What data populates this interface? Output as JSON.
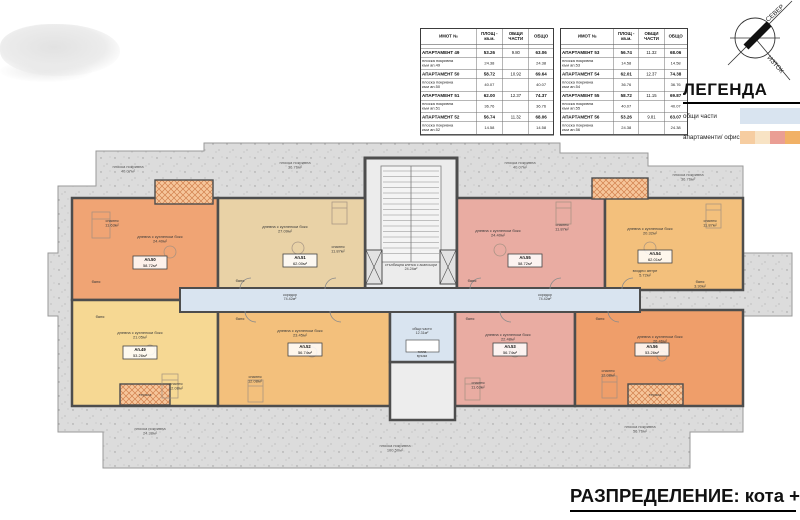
{
  "tables": {
    "headers": [
      "ИМОТ №",
      "ПЛОЩ - кв.м.",
      "ОБЩИ ЧАСТИ",
      "ОБЩО"
    ],
    "left": {
      "rows": [
        {
          "type": "apt",
          "label": "АПАРТАМЕНТ 49",
          "area": "53.26",
          "common": "9.80",
          "total": "63.06"
        },
        {
          "type": "roof",
          "label": "плоска покривна",
          "label2": "към ап.49",
          "area": "24.38",
          "common": "",
          "total": "24.38"
        },
        {
          "type": "apt",
          "label": "АПАРТАМЕНТ 50",
          "area": "58.72",
          "common": "10.92",
          "total": "69.64"
        },
        {
          "type": "roof",
          "label": "плоска покривна",
          "label2": "към ап.50",
          "area": "40.07",
          "common": "",
          "total": "40.07"
        },
        {
          "type": "apt",
          "label": "АПАРТАМЕНТ 51",
          "area": "62.00",
          "common": "12.37",
          "total": "74.37"
        },
        {
          "type": "roof",
          "label": "плоска покривна",
          "label2": "към ап.51",
          "area": "36.76",
          "common": "",
          "total": "36.76"
        },
        {
          "type": "apt",
          "label": "АПАРТАМЕНТ 52",
          "area": "56.74",
          "common": "11.32",
          "total": "68.06"
        },
        {
          "type": "roof",
          "label": "плоска покривна",
          "label2": "към ап.52",
          "area": "14.58",
          "common": "",
          "total": "14.58"
        }
      ]
    },
    "right": {
      "rows": [
        {
          "type": "apt",
          "label": "АПАРТАМЕНТ 53",
          "area": "56.74",
          "common": "11.32",
          "total": "68.06"
        },
        {
          "type": "roof",
          "label": "плоска покривна",
          "label2": "към ап.53",
          "area": "14.58",
          "common": "",
          "total": "14.58"
        },
        {
          "type": "apt",
          "label": "АПАРТАМЕНТ 54",
          "area": "62.01",
          "common": "12.37",
          "total": "74.38"
        },
        {
          "type": "roof",
          "label": "плоска покривна",
          "label2": "към ап.54",
          "area": "36.76",
          "common": "",
          "total": "36.76"
        },
        {
          "type": "apt",
          "label": "АПАРТАМЕНТ 55",
          "area": "58.72",
          "common": "11.15",
          "total": "69.87"
        },
        {
          "type": "roof",
          "label": "плоска покривна",
          "label2": "към ап.55",
          "area": "40.07",
          "common": "",
          "total": "40.07"
        },
        {
          "type": "apt",
          "label": "АПАРТАМЕНТ 56",
          "area": "53.26",
          "common": "9.81",
          "total": "63.07"
        },
        {
          "type": "roof",
          "label": "плоска покривна",
          "label2": "към ап.56",
          "area": "24.38",
          "common": "",
          "total": "24.38"
        }
      ]
    }
  },
  "legend": {
    "title": "ЛЕГЕНДА",
    "items": [
      {
        "label": "общи части",
        "color": "#d9e4f0"
      },
      {
        "label": "апартаменти/ офиси",
        "colors": [
          "#f6cda1",
          "#f8e3c4",
          "#ea9e94",
          "#f1b166"
        ]
      }
    ]
  },
  "compass": {
    "north": "СЕВЕР",
    "east": "ИЗТОК"
  },
  "title_block": {
    "text": "РАЗПРЕДЕЛЕНИЕ: кота +14.88"
  },
  "plan": {
    "stair_label": {
      "lines": [
        "стълбищна клетка с асансьори",
        "24.24м²"
      ],
      "x": 411,
      "y": 266
    },
    "lobby_label": {
      "lines": [
        "общи части",
        "12.31м²"
      ],
      "x": 422,
      "y": 330
    },
    "link_label": {
      "lines": [
        "топла",
        "връзка"
      ],
      "x": 422,
      "y": 349
    },
    "corridor_labels": [
      {
        "lines": [
          "коридор",
          "74.42м²"
        ],
        "x": 290,
        "y": 296
      },
      {
        "lines": [
          "коридор",
          "74.42м²"
        ],
        "x": 545,
        "y": 296
      }
    ],
    "units": [
      {
        "id": "Ап.49",
        "area": "53.26м²",
        "x": 140,
        "y": 352
      },
      {
        "id": "Ап.50",
        "area": "58.72м²",
        "x": 150,
        "y": 262
      },
      {
        "id": "Ап.51",
        "area": "62.00м²",
        "x": 300,
        "y": 260
      },
      {
        "id": "Ап.52",
        "area": "56.74м²",
        "x": 305,
        "y": 349
      },
      {
        "id": "Ап.53",
        "area": "56.74м²",
        "x": 510,
        "y": 349
      },
      {
        "id": "Ап.54",
        "area": "62.01м²",
        "x": 655,
        "y": 256
      },
      {
        "id": "Ап.55",
        "area": "58.72м²",
        "x": 525,
        "y": 260
      },
      {
        "id": "Ап.56",
        "area": "53.26м²",
        "x": 652,
        "y": 349
      }
    ],
    "rooms": [
      {
        "lines": [
          "спалня",
          "11.63м²"
        ],
        "x": 112,
        "y": 222
      },
      {
        "lines": [
          "дневна с кухненски бокс",
          "24.40м²"
        ],
        "x": 160,
        "y": 238
      },
      {
        "lines": [
          "баня"
        ],
        "x": 96,
        "y": 283
      },
      {
        "lines": [
          "дневна с кухненски бокс",
          "27.09м²"
        ],
        "x": 285,
        "y": 228
      },
      {
        "lines": [
          "спалня",
          "11.87м²"
        ],
        "x": 338,
        "y": 248
      },
      {
        "lines": [
          "баня"
        ],
        "x": 240,
        "y": 282
      },
      {
        "lines": [
          "дневна с кухненски бокс",
          "24.40м²"
        ],
        "x": 498,
        "y": 232
      },
      {
        "lines": [
          "спалня",
          "11.87м²"
        ],
        "x": 562,
        "y": 226
      },
      {
        "lines": [
          "баня"
        ],
        "x": 472,
        "y": 282
      },
      {
        "lines": [
          "дневна с кухненски бокс",
          "20.32м²"
        ],
        "x": 650,
        "y": 230
      },
      {
        "lines": [
          "спалня",
          "11.87м²"
        ],
        "x": 710,
        "y": 222
      },
      {
        "lines": [
          "входно антре",
          "5.72м²"
        ],
        "x": 645,
        "y": 272
      },
      {
        "lines": [
          "баня",
          "3.30м²"
        ],
        "x": 700,
        "y": 283
      },
      {
        "lines": [
          "дневна с кухненски бокс",
          "21.05м²"
        ],
        "x": 140,
        "y": 334
      },
      {
        "lines": [
          "спалня",
          "12.08м²"
        ],
        "x": 176,
        "y": 385
      },
      {
        "lines": [
          "баня"
        ],
        "x": 100,
        "y": 318
      },
      {
        "lines": [
          "дневна с кухненски бокс",
          "23.45м²"
        ],
        "x": 300,
        "y": 332
      },
      {
        "lines": [
          "спалня",
          "12.08м²"
        ],
        "x": 255,
        "y": 378
      },
      {
        "lines": [
          "баня"
        ],
        "x": 240,
        "y": 320
      },
      {
        "lines": [
          "дневна с кухненски бокс",
          "22.48м²"
        ],
        "x": 508,
        "y": 336
      },
      {
        "lines": [
          "спалня",
          "11.63м²"
        ],
        "x": 478,
        "y": 384
      },
      {
        "lines": [
          "баня"
        ],
        "x": 470,
        "y": 320
      },
      {
        "lines": [
          "дневна с кухненски бокс",
          "26.46м²"
        ],
        "x": 660,
        "y": 338
      },
      {
        "lines": [
          "спалня",
          "12.08м²"
        ],
        "x": 608,
        "y": 372
      },
      {
        "lines": [
          "баня"
        ],
        "x": 600,
        "y": 320
      },
      {
        "lines": [
          "тераса"
        ],
        "x": 145,
        "y": 396
      },
      {
        "lines": [
          "тераса"
        ],
        "x": 655,
        "y": 396
      }
    ],
    "terrace_labels": [
      {
        "lines": [
          "плоска покривна",
          "40.07м²"
        ],
        "x": 128,
        "y": 168
      },
      {
        "lines": [
          "плоска покривна",
          "36.76м²"
        ],
        "x": 295,
        "y": 164
      },
      {
        "lines": [
          "плоска покривна",
          "40.07м²"
        ],
        "x": 520,
        "y": 164
      },
      {
        "lines": [
          "плоска покривна",
          "36.76м²"
        ],
        "x": 688,
        "y": 176
      },
      {
        "lines": [
          "плоска покривна",
          "24.38м²"
        ],
        "x": 150,
        "y": 430
      },
      {
        "lines": [
          "плоска покривна",
          "100.50м²"
        ],
        "x": 395,
        "y": 447
      },
      {
        "lines": [
          "плоска покривна",
          "56.76м²"
        ],
        "x": 640,
        "y": 428
      }
    ]
  },
  "colors": {
    "terrace_gray": "#dcdcdc",
    "wall": "#4d4d4d",
    "common_blue": "#d9e4f0",
    "unit_orange": "#f0a474",
    "unit_tan": "#e9d2a6",
    "unit_pink": "#e9aca2",
    "unit_amber": "#f3c07c",
    "unit_yellow": "#f6d893",
    "unit_orange_deep": "#ef9e6a",
    "hatch_bg": "#f6c69b",
    "hatch_line": "#d1804d"
  }
}
